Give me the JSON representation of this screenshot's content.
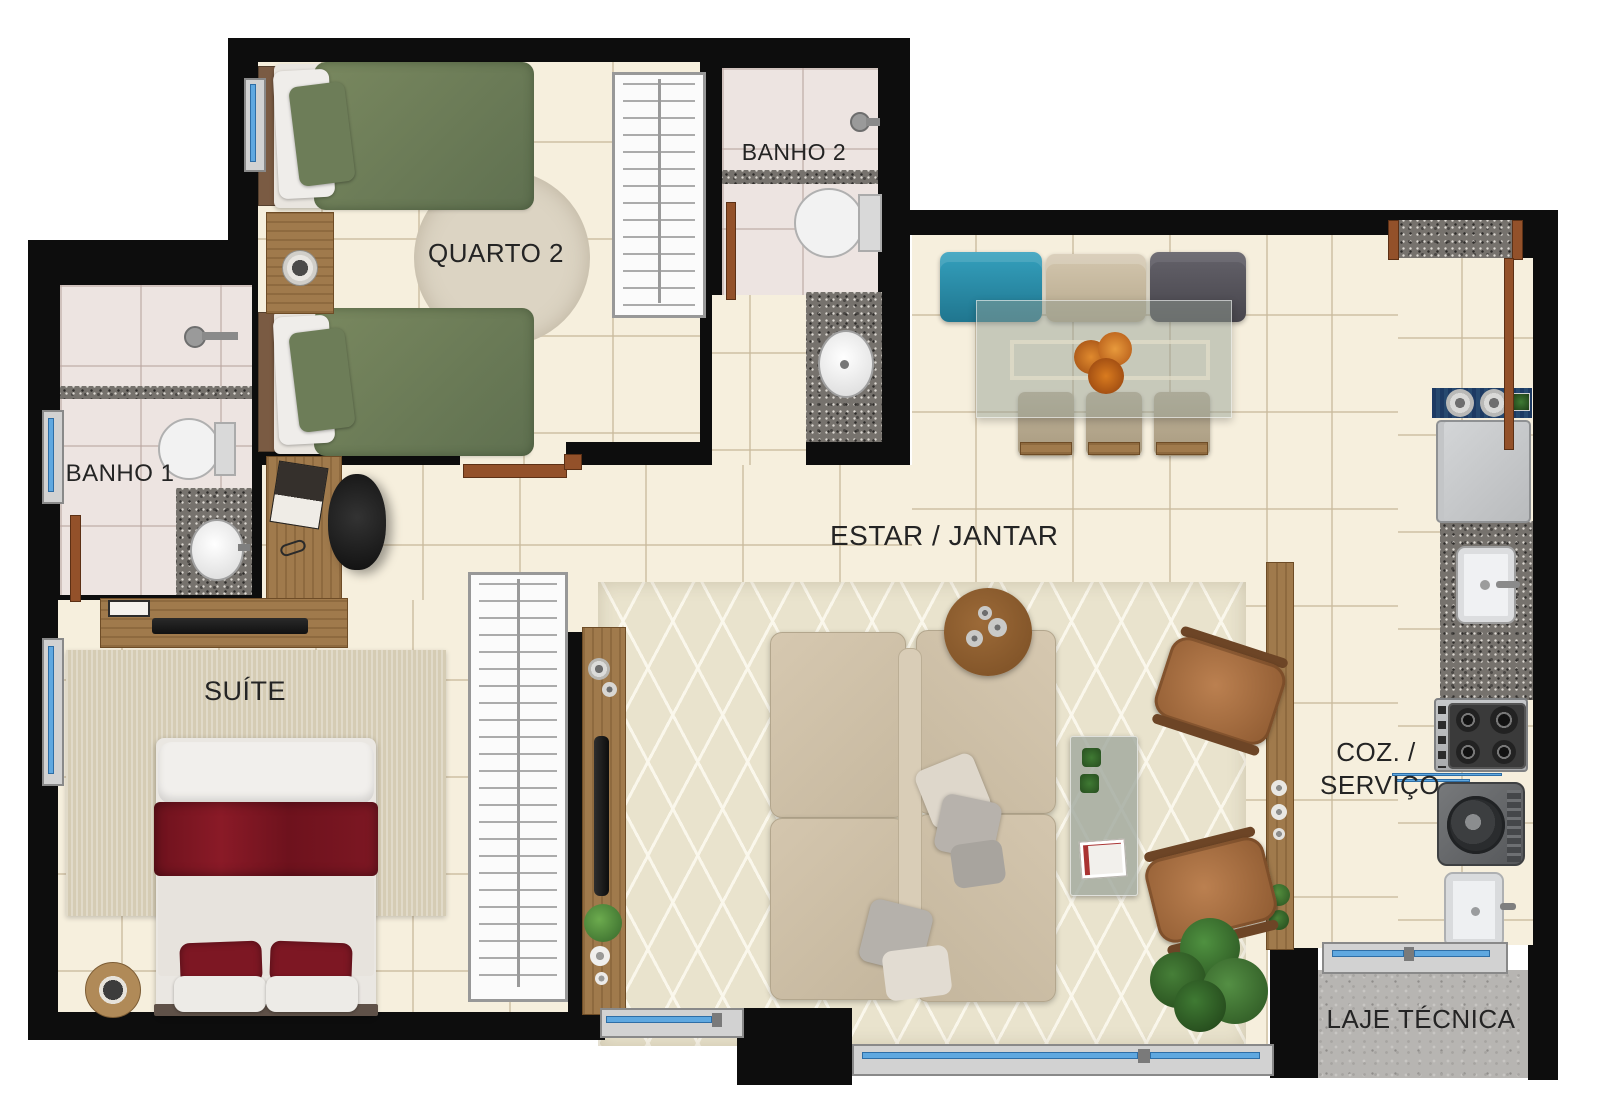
{
  "plan": {
    "type": "apartment-floor-plan",
    "rooms": {
      "quarto2": {
        "label": "QUARTO 2"
      },
      "banho2": {
        "label": "BANHO 2"
      },
      "banho1": {
        "label": "BANHO 1"
      },
      "suite": {
        "label": "SUÍTE"
      },
      "estar_jantar": {
        "label": "ESTAR / JANTAR"
      },
      "coz_servico": {
        "line1": "COZ. /",
        "line2": "SERVIÇO"
      },
      "laje_tecnica": {
        "label": "LAJE TÉCNICA"
      }
    },
    "colors": {
      "wall": "#0d0d0d",
      "floor_tile": "#f6efdd",
      "bath_tile": "#ede4e1",
      "granite": "#76726d",
      "concrete": "#b7b5b2",
      "wood": "#a07a4c",
      "door": "#93512a",
      "window_glass": "#5fa8e0",
      "bed_green": "#6f8059",
      "bed_red": "#7d1723",
      "sofa_beige": "#d2c4ac",
      "rug_beige": "#e9e3cd",
      "chair_teal": "#2d8ba5",
      "chair_dark": "#57555a",
      "leather": "#a96e40",
      "plant_green": "#3f7a33"
    },
    "furniture": [
      "single-bed",
      "single-bed",
      "nightstand-with-lamp",
      "round-rug",
      "wardrobe-closet",
      "toilet",
      "shower-head",
      "washbasin",
      "vanity-counter",
      "desk",
      "book",
      "office-chair",
      "wardrobe-closet",
      "double-bed",
      "red-throw",
      "bedside-round-table",
      "tv-panel",
      "bedroom-rug",
      "tv-console",
      "living-rug",
      "sectional-sofa",
      "throw-pillows",
      "round-side-table",
      "coffee-table",
      "leather-armchair",
      "leather-armchair",
      "floor-plant",
      "dining-glass-table",
      "flower-centerpiece",
      "dining-chair-teal",
      "dining-chair-beige",
      "dining-chair-gray",
      "dining-chair",
      "dining-chair",
      "dining-chair",
      "pass-through-counter",
      "kitchen-runner",
      "refrigerator",
      "kitchen-sink",
      "granite-counter",
      "cooktop",
      "washing-machine",
      "laundry-tub",
      "service-divider"
    ]
  }
}
